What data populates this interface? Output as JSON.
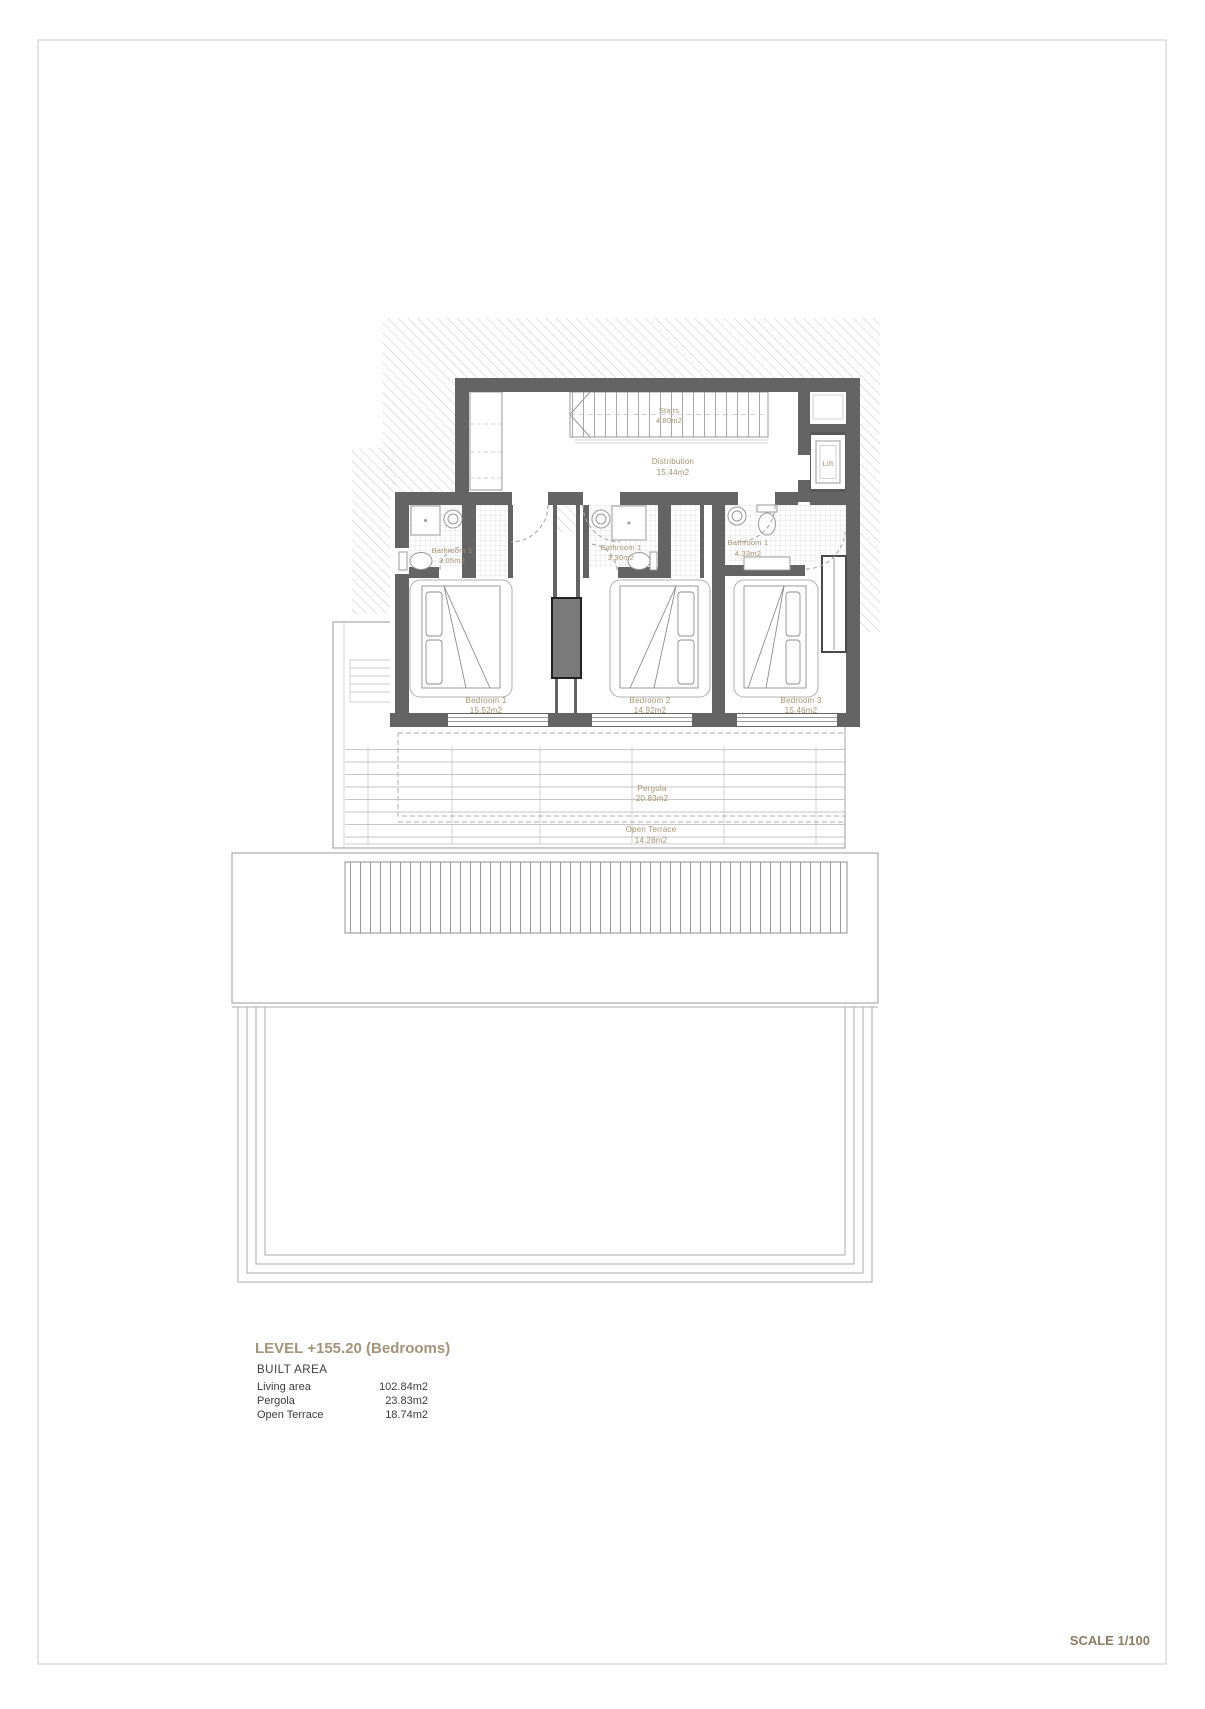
{
  "page": {
    "plan": {
      "rooms": {
        "stairs": {
          "name": "Stairs",
          "area": "4.80m2"
        },
        "distribution": {
          "name": "Distribution",
          "area": "15.44m2"
        },
        "lift": {
          "name": "Lift"
        },
        "bathroom_1": {
          "name": "Bathroom 1",
          "area": "3.05m2"
        },
        "bathroom_2": {
          "name": "Bathroom 1",
          "area": "3.30m2"
        },
        "bathroom_3": {
          "name": "Bathroom 1",
          "area": "4.33m2"
        },
        "bedroom_1": {
          "name": "Bedroom 1",
          "area": "15.52m2"
        },
        "bedroom_2": {
          "name": "Bedroom 2",
          "area": "14.92m2"
        },
        "bedroom_3": {
          "name": "Bedroom 3",
          "area": "15.46m2"
        },
        "pergola": {
          "name": "Pergola",
          "area": "20.83m2"
        },
        "open_terrace": {
          "name": "Open Terrace",
          "area": "14.28m2"
        }
      }
    },
    "title_block": {
      "level_title": "LEVEL +155.20 (Bedrooms)",
      "built_area_heading": "BUILT AREA",
      "area_rows": [
        {
          "label": "Living area",
          "value": "102.84m2"
        },
        {
          "label": "Pergola",
          "value": "23.83m2"
        },
        {
          "label": "Open Terrace",
          "value": "18.74m2"
        }
      ],
      "scale_label": "SCALE 1/100"
    },
    "colors": {
      "wall": "#646464",
      "room_label": "#a5946f",
      "title": "#a29379",
      "scale_text": "#8d7c63",
      "body_text": "#3c3c3c"
    }
  }
}
